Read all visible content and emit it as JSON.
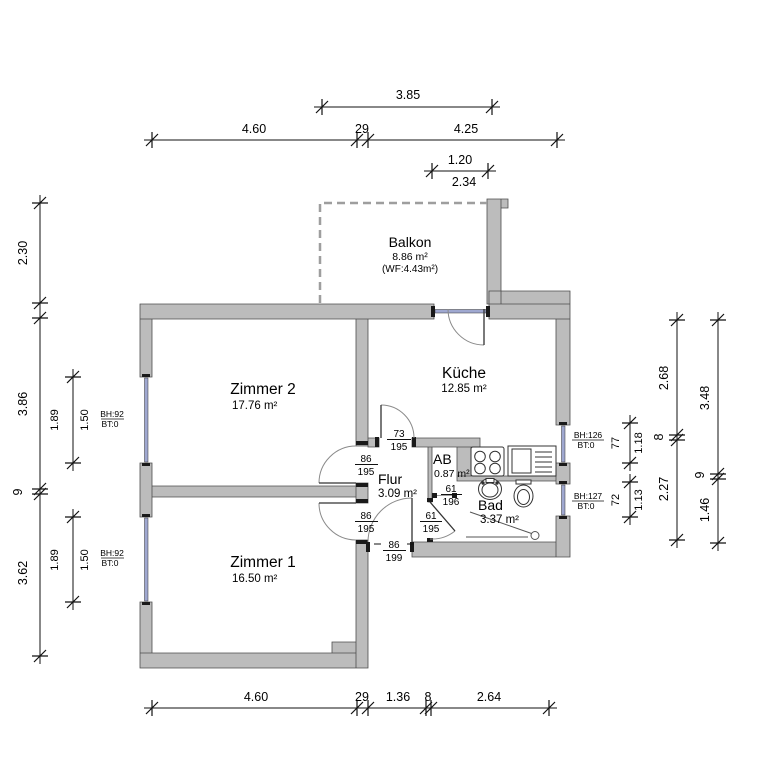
{
  "plan": {
    "rooms": [
      {
        "name": "Balkon",
        "area": "8.86 m²",
        "note": "(WF:4.43m²)"
      },
      {
        "name": "Zimmer 2",
        "area": "17.76 m²"
      },
      {
        "name": "Küche",
        "area": "12.85 m²"
      },
      {
        "name": "Flur",
        "area": "3.09 m²"
      },
      {
        "name": "AB",
        "area": "0.87 m²"
      },
      {
        "name": "Bad",
        "area": "3.37 m²"
      },
      {
        "name": "Zimmer 1",
        "area": "16.50 m²"
      }
    ],
    "doors": [
      {
        "id": "kueche-door",
        "width": "73",
        "height": "195"
      },
      {
        "id": "zimmer2-door",
        "width": "86",
        "height": "195"
      },
      {
        "id": "zimmer1-door",
        "width": "86",
        "height": "195"
      },
      {
        "id": "entrance-door",
        "width": "86",
        "height": "199"
      },
      {
        "id": "ab-door",
        "width": "61",
        "height": "196"
      },
      {
        "id": "bad-door",
        "width": "61",
        "height": "195"
      }
    ],
    "windows": [
      {
        "id": "zimmer2-window",
        "sill": "BH:92",
        "bt": "BT:0",
        "outer": "1.89",
        "inner": "1.50"
      },
      {
        "id": "zimmer1-window",
        "sill": "BH:92",
        "bt": "BT:0",
        "outer": "1.89",
        "inner": "1.50"
      },
      {
        "id": "kueche-window",
        "sill": "BH:126",
        "bt": "BT:0",
        "outer": "77",
        "inner": "1.18"
      },
      {
        "id": "bad-window",
        "sill": "BH:127",
        "bt": "BT:0",
        "outer": "72",
        "inner": "1.13"
      }
    ],
    "dims": {
      "top_balcony": "3.85",
      "top": [
        "4.60",
        "29",
        "4.25"
      ],
      "balcony_door": [
        "1.20",
        "2.34"
      ],
      "left_balcony": "2.30",
      "left": [
        "3.86",
        "9",
        "3.62"
      ],
      "right_inner": [
        "2.68",
        "8",
        "2.27"
      ],
      "right_outer": [
        "3.48",
        "9",
        "1.46"
      ],
      "bottom": [
        "4.60",
        "29",
        "1.36",
        "8",
        "2.64"
      ]
    },
    "fixtures": [
      "cooktop",
      "sink",
      "washbasin",
      "toilet",
      "shower"
    ],
    "colors": {
      "wall": "#bcbcbc",
      "glazing": "#9fa8d0",
      "outline": "#4d4d4d"
    }
  }
}
